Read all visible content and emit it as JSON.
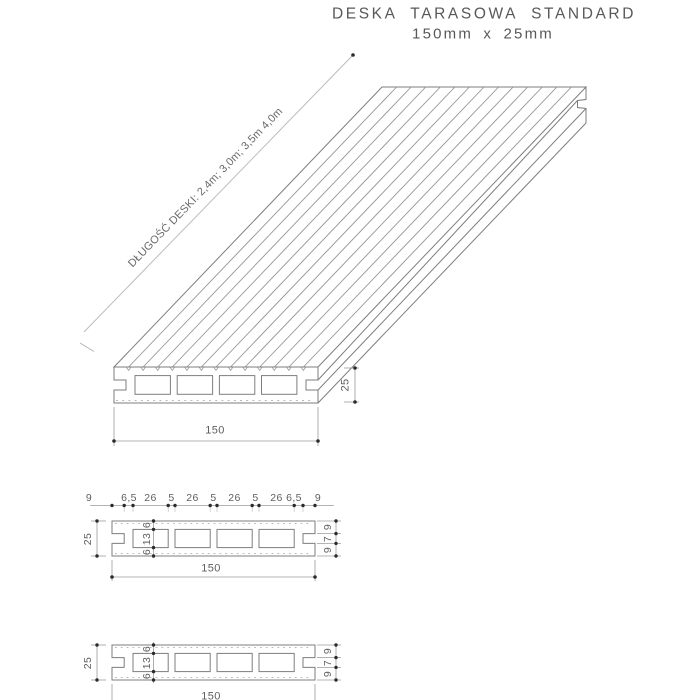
{
  "title": {
    "line1": "DESKA TARASOWA STANDARD",
    "line2": "150mm x 25mm"
  },
  "isometric": {
    "length_note": "DŁUGOŚĆ DESKI: 2,4m; 3,0m; 3,5m 4,0m",
    "width_dim": "150",
    "thickness_dim": "25"
  },
  "sections": {
    "top": {
      "top_chain": [
        "9",
        "6,5",
        "26",
        "5",
        "26",
        "5",
        "26",
        "5",
        "26",
        "6,5",
        "9"
      ],
      "left_dim": "25",
      "right_chain": [
        "9",
        "7",
        "9"
      ],
      "inner_chain": [
        "6",
        "13",
        "6"
      ],
      "bottom_dim": "150"
    },
    "bottom": {
      "left_dim": "25",
      "right_chain": [
        "9",
        "7",
        "9"
      ],
      "inner_chain": [
        "6",
        "13",
        "6"
      ],
      "bottom_dim": "150"
    }
  },
  "colors": {
    "background": "#ffffff",
    "part_line": "#7d7d7d",
    "groove_line": "#959595",
    "dim_line": "#999999",
    "dot": "#2b2b2b",
    "text": "#5e5e5e"
  }
}
